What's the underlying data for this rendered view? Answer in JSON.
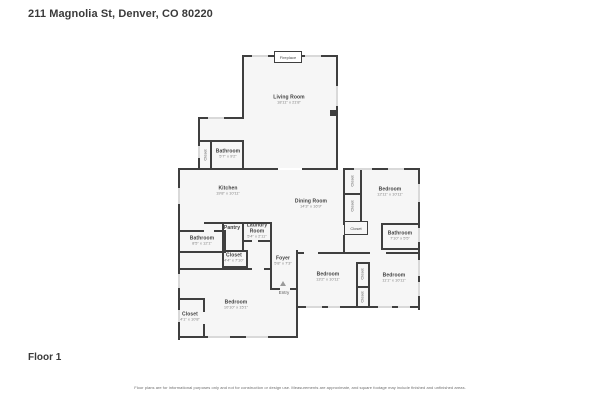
{
  "header": {
    "title": "211 Magnolia St, Denver, CO 80220"
  },
  "footer": {
    "floor_label": "Floor 1",
    "disclaimer": "Floor plans are for informational purposes only and not for construction or design use. Measurements are approximate, and square footage may include finished and unfinished areas."
  },
  "colors": {
    "wall": "#3f3f3f",
    "room_fill": "#f6f6f6",
    "window": "#d9d9d9",
    "text": "#3f3f3f",
    "dims_text": "#828282"
  },
  "icons": {
    "entry_direction": "triangle-up"
  },
  "rooms": {
    "living": {
      "name": "Living Room",
      "dims": "18'11\" x 21'8\""
    },
    "kitchen": {
      "name": "Kitchen",
      "dims": "19'8\" x 10'11\""
    },
    "dining": {
      "name": "Dining Room",
      "dims": "14'3\" x 16'9\""
    },
    "bed_tr": {
      "name": "Bedroom",
      "dims": "12'11\" x 10'11\""
    },
    "bath_r": {
      "name": "Bathroom",
      "dims": "7'10\" x 5'5\""
    },
    "bath_ul": {
      "name": "Bathroom",
      "dims": "5'7\" x 9'2\""
    },
    "bath_ml": {
      "name": "Bathroom",
      "dims": "8'5\" x 12'1\""
    },
    "pantry": {
      "name": "Pantry"
    },
    "laundry": {
      "name": "Laundry Room",
      "dims": "5'4\" x 2'11\""
    },
    "foyer": {
      "name": "Foyer",
      "dims": "5'8\" x 7'3\""
    },
    "entry": {
      "name": "Entry"
    },
    "bed_bm": {
      "name": "Bedroom",
      "dims": "13'2\" x 10'11\""
    },
    "bed_br": {
      "name": "Bedroom",
      "dims": "11'1\" x 10'11\""
    },
    "bed_bl": {
      "name": "Bedroom",
      "dims": "10'10\" x 15'1\""
    },
    "closet_ml": {
      "name": "Closet",
      "dims": "4'4\" x 7'10\""
    },
    "closet_bl": {
      "name": "Closet",
      "dims": "4'1\" x 10'8\""
    },
    "closet_ul": {
      "name": "Closet"
    },
    "closet_tr1": {
      "name": "Closet"
    },
    "closet_tr2": {
      "name": "Closet"
    },
    "closet_box": {
      "name": "Closet"
    },
    "closet_bm1": {
      "name": "Closet"
    },
    "closet_bm2": {
      "name": "Closet"
    },
    "fireplace": {
      "name": "Fireplace"
    }
  }
}
